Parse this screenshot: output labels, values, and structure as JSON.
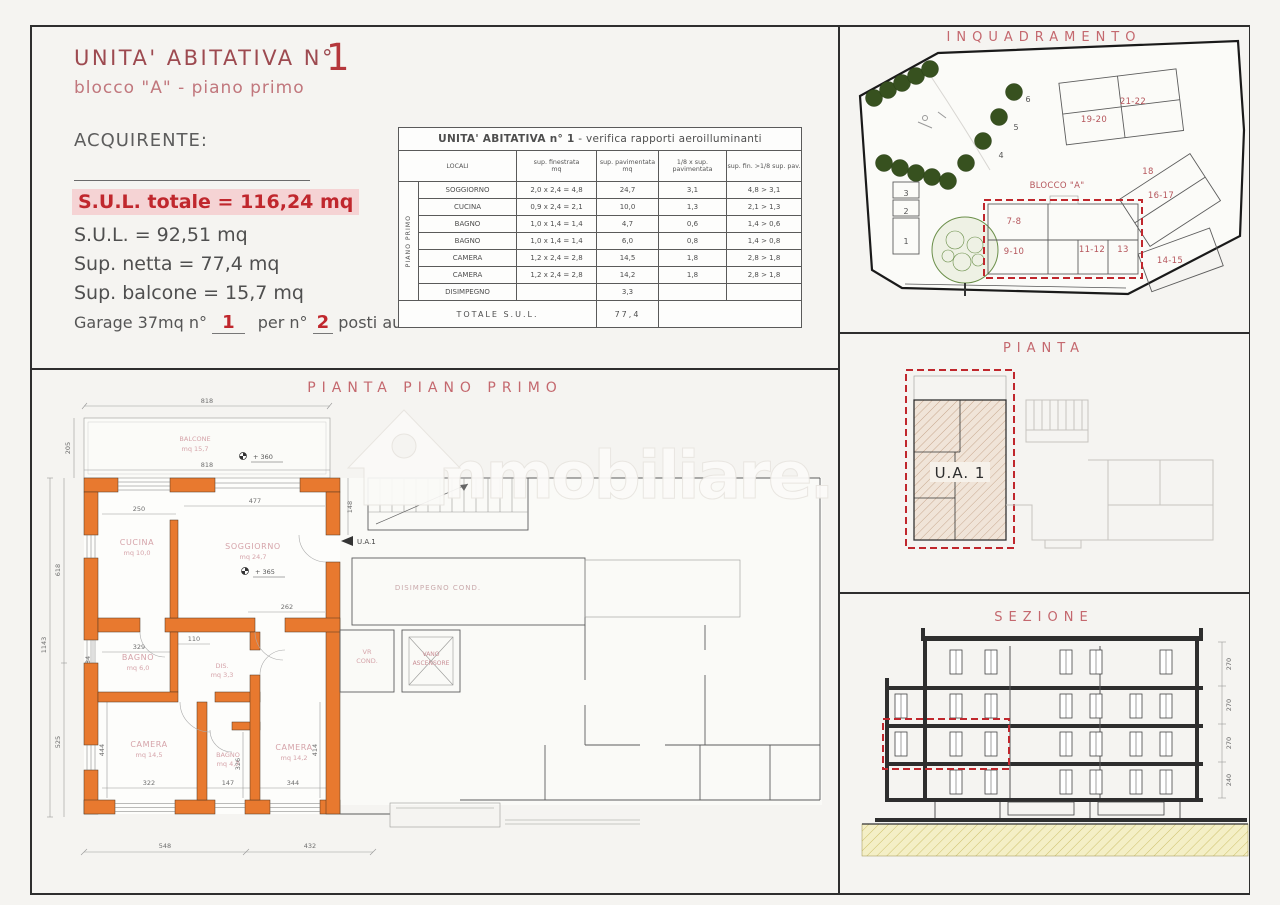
{
  "colors": {
    "wall_orange": "#e8792f",
    "accent_red": "#c0272d",
    "title_red": "#9d4a50",
    "panel_pink": "#c4686e"
  },
  "header": {
    "unit_title": "UNITA' ABITATIVA  N°",
    "unit_number": "1",
    "subtitle": "blocco \"A\" - piano primo",
    "acquirente": "ACQUIRENTE:",
    "sul_totale": "S.U.L. totale = 116,24 mq",
    "sul": "S.U.L. = 92,51 mq",
    "sup_netta": "Sup. netta = 77,4 mq",
    "sup_balcone": "Sup. balcone = 15,7 mq",
    "garage_prefix": "Garage 37mq n°",
    "garage_number": "1",
    "garage_mid": "per n°",
    "garage_posti": "2",
    "garage_suffix": "posti auto"
  },
  "aero_table": {
    "title": "UNITA' ABITATIVA  n° 1",
    "title_suffix": " - verifica rapporti aeroilluminanti",
    "side_label": "PIANO PRIMO",
    "headers": [
      "LOCALI",
      "sup. finestrata\nmq",
      "sup. pavimentata\nmq",
      "1/8 x sup.\npavimentata",
      "sup. fin. >1/8 sup. pav."
    ],
    "rows": [
      {
        "locale": "SOGGIORNO",
        "fin": "2,0 x 2,4 = 4,8",
        "pav": "24,7",
        "ottavo": "3,1",
        "verifica": "4,8 > 3,1"
      },
      {
        "locale": "CUCINA",
        "fin": "0,9 x 2,4 = 2,1",
        "pav": "10,0",
        "ottavo": "1,3",
        "verifica": "2,1 > 1,3"
      },
      {
        "locale": "BAGNO",
        "fin": "1,0 x 1,4 = 1,4",
        "pav": "4,7",
        "ottavo": "0,6",
        "verifica": "1,4 > 0,6"
      },
      {
        "locale": "BAGNO",
        "fin": "1,0 x 1,4 = 1,4",
        "pav": "6,0",
        "ottavo": "0,8",
        "verifica": "1,4 > 0,8"
      },
      {
        "locale": "CAMERA",
        "fin": "1,2 x 2,4 = 2,8",
        "pav": "14,5",
        "ottavo": "1,8",
        "verifica": "2,8 > 1,8"
      },
      {
        "locale": "CAMERA",
        "fin": "1,2 x 2,4 = 2,8",
        "pav": "14,2",
        "ottavo": "1,8",
        "verifica": "2,8 > 1,8"
      },
      {
        "locale": "DISIMPEGNO",
        "fin": "",
        "pav": "3,3",
        "ottavo": "",
        "verifica": ""
      }
    ],
    "totale_label": "TOTALE  S.U.L.",
    "totale_value": "77,4"
  },
  "inquadramento": {
    "title": "INQUADRAMENTO",
    "blocco": "BLOCCO \"A\"",
    "units": {
      "u78": "7-8",
      "u910": "9-10",
      "u1112": "11-12",
      "u13": "13",
      "u1415": "14-15",
      "u1617": "16-17",
      "u18": "18",
      "u1920": "19-20",
      "u2122": "21-22"
    },
    "numbers": {
      "n1": "1",
      "n2": "2",
      "n3": "3",
      "n4": "4",
      "n5": "5",
      "n6": "6"
    }
  },
  "pianta": {
    "title": "PIANTA",
    "unit": "U.A. 1"
  },
  "sezione": {
    "title": "SEZIONE",
    "dims": [
      "270",
      "270",
      "270",
      "240"
    ]
  },
  "plan": {
    "title": "PIANTA  PIANO  PRIMO",
    "rooms": {
      "balcone": {
        "name": "BALCONE",
        "mq": "mq 15,7"
      },
      "cucina": {
        "name": "CUCINA",
        "mq": "mq 10,0"
      },
      "soggiorno": {
        "name": "SOGGIORNO",
        "mq": "mq 24,7"
      },
      "bagno1": {
        "name": "BAGNO",
        "mq": "mq 6,0"
      },
      "dis": {
        "name": "DIS.",
        "mq": "mq 3,3"
      },
      "bagno2": {
        "name": "BAGNO",
        "mq": "mq 4,7"
      },
      "camera1": {
        "name": "CAMERA",
        "mq": "mq 14,5"
      },
      "camera2": {
        "name": "CAMERA",
        "mq": "mq 14,2"
      }
    },
    "labels": {
      "ua": "U.A.1",
      "vr1": "VR",
      "vr2": "COND.",
      "va1": "VANO",
      "va2": "ASCENSORE",
      "dcond": "DISIMPEGNO COND."
    },
    "levels": {
      "balcone": "+ 360",
      "soggiorno": "+ 365"
    },
    "dims": {
      "top": "818",
      "top2": "818",
      "w_cucina": "250",
      "w_sogg": "477",
      "d262": "262",
      "w_bagno": "329",
      "d110": "110",
      "w_cam1": "322",
      "d147": "147",
      "w_cam2": "344",
      "b548": "548",
      "b432": "432",
      "l205": "205",
      "l618": "618",
      "l1143": "1143",
      "l525": "525",
      "r148": "148",
      "r414": "414",
      "d326": "326",
      "d184": "184",
      "d444": "444"
    }
  },
  "watermark": {
    "text": "immobiliare."
  }
}
